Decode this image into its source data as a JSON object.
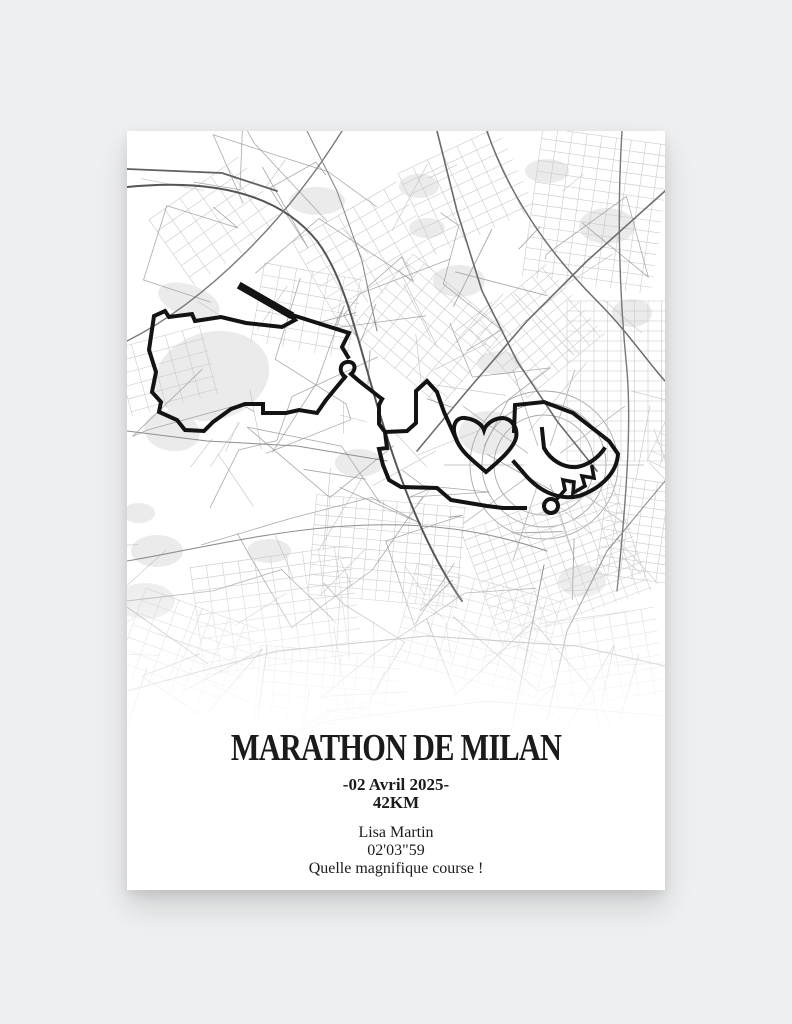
{
  "page": {
    "background_color": "#eff0f1"
  },
  "poster": {
    "title": "MARATHON DE MILAN",
    "date": "-02 Avril 2025-",
    "distance": "42KM",
    "runner_name": "Lisa Martin",
    "finish_time": "02'03\"59",
    "caption": "Quelle magnifique course !"
  },
  "map": {
    "background_color": "#ffffff",
    "street_color": "#9a9a9a",
    "park_color": "#ebebeb",
    "route_color": "#131313",
    "route_segments": [
      {
        "d": "M115,156 L162,183",
        "w": 7.5
      },
      {
        "d": "M162,183 L222,202 L215,216 L221,226",
        "w": 4
      },
      {
        "d": "M115,156 L162,183 L168,189 L155,196 L119,192 L94,186 L68,190 L65,183 L42,186 L38,180 L27,185 L22,219 L29,241 L25,261 L34,271 L32,281 L50,289 L58,299 L77,300 L86,291 L104,278 L118,273 L136,273 L136,282 L159,282 L172,279 L190,282 L199,269 L208,258 L218,246",
        "w": 4
      },
      {
        "d": "M218,246 C212,242 212,232 220,231 C228,230 230,238 224,243 L232,250 L255,268",
        "w": 4
      },
      {
        "d": "M255,268 L252,274 L252,293 L258,301 L280,300 L289,292 L289,260 L300,250 L310,261 L317,281 L330,310",
        "w": 4
      },
      {
        "d": "M330,310 C323,295 329,286 338,287 C347,288 355,293 357,299 C359,293 367,287 376,287 C385,288 391,297 389,307 C386,318 372,330 359,341 C348,331 335,322 330,310 Z",
        "w": 4
      },
      {
        "d": "M387,300 L388,274 L417,271 L446,282 L482,310 L491,323 C490,341 475,357 452,365 C430,370 410,359 395,340 L387,331",
        "w": 4
      },
      {
        "d": "M415,298 L417,317 C424,330 437,337 450,336 C461,334 471,327 477,318",
        "w": 4
      },
      {
        "d": "M429,369 L438,359 L436,349 L447,351 L446,362 L458,355 L455,345 L467,347 L465,336",
        "w": 3.6
      },
      {
        "d": "M258,301 L260,317 L252,318 L256,334 L262,349 L274,356 L310,357 L324,369 L342,372 L360,375 L376,377 L398,377",
        "w": 4
      }
    ],
    "route_marker": {
      "cx": 424,
      "cy": 375,
      "r": 7
    }
  }
}
